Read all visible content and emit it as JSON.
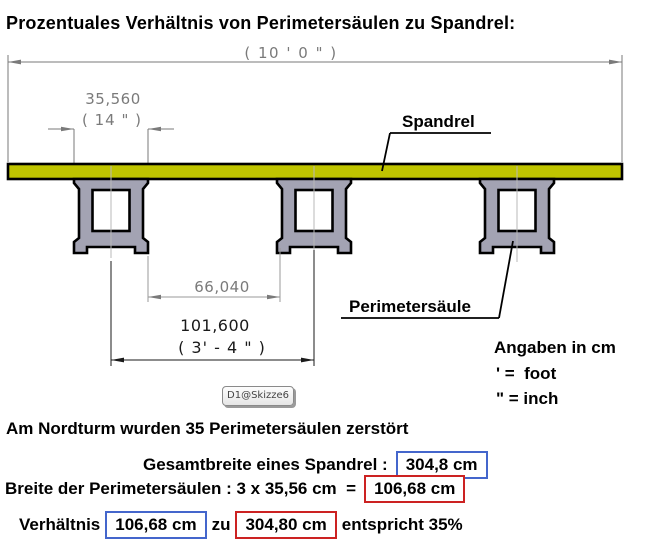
{
  "title": "Prozentuales Verhältnis von Perimetersäulen zu Spandrel:",
  "diagram": {
    "dimensions": {
      "overall": "( 10 ' 0 \" )",
      "column_width": "35,560",
      "column_width_imperial": "( 14 \" )",
      "gap": "66,040",
      "spacing": "101,600",
      "spacing_imperial": "( 3' - 4 \" )"
    },
    "labels": {
      "spandrel": "Spandrel",
      "column": "Perimetersäule"
    },
    "sketch_tag": "D1@Skizze6",
    "colors": {
      "spandrel_fill": "#bfc400",
      "column_fill": "#a3a3b3",
      "dimension_gray": "#7a7a7a",
      "outline": "#000000"
    }
  },
  "legend": {
    "title": "Angaben in cm",
    "foot": "' =  foot",
    "inch": "\" = inch"
  },
  "notes": {
    "line1": "Am Nordturm wurden 35 Perimetersäulen zerstört",
    "line2_label": "Gesamtbreite eines Spandrel :",
    "line2_value": "304,8 cm",
    "line3_label": "Breite der Perimetersäulen : 3 x 35,56 cm  =",
    "line3_value": "106,68 cm",
    "line4_prefix": "Verhältnis",
    "line4_value1": "106,68 cm",
    "line4_mid": "zu",
    "line4_value2": "304,80 cm",
    "line4_suffix": "entspricht 35%"
  },
  "colors": {
    "box_blue": "#4466cc",
    "box_red": "#cc2222"
  }
}
